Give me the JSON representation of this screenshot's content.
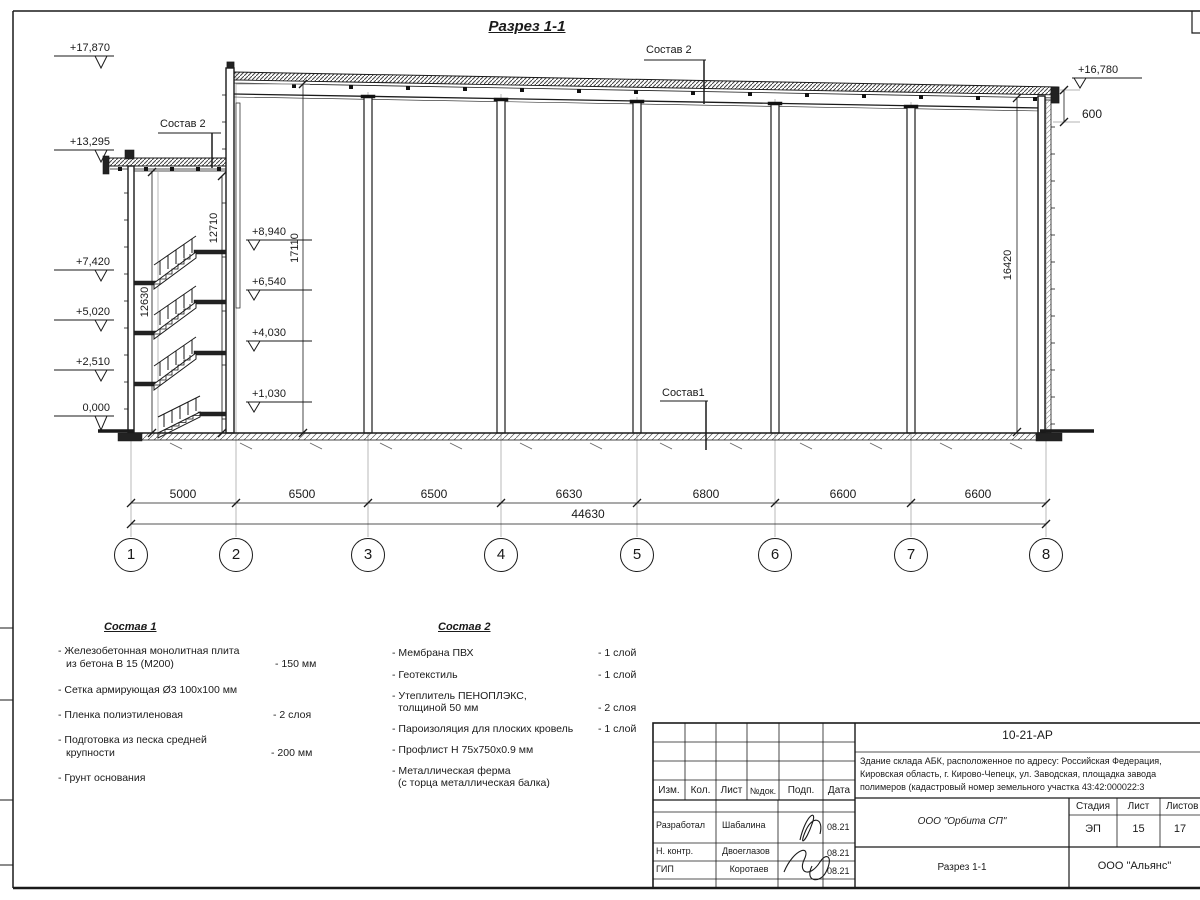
{
  "sheet": {
    "title": "Разрез 1-1"
  },
  "callouts": {
    "sostav2_roof_top": "Состав 2",
    "sostav2_roof_left": "Состав 2",
    "sostav1_floor": "Состав1"
  },
  "elevations": {
    "left": [
      "+17,870",
      "+13,295",
      "+7,420",
      "+5,020",
      "+2,510",
      "0,000"
    ],
    "stair": [
      "+8,940",
      "+6,540",
      "+4,030",
      "+1,030"
    ],
    "right": "+16,780",
    "parapet_offset": "600"
  },
  "vdims": {
    "stair_inner": "12630",
    "stair_outer": "12710",
    "hall_left": "17110",
    "hall_right": "16420"
  },
  "hdims": {
    "spans": [
      "5000",
      "6500",
      "6500",
      "6630",
      "6800",
      "6600",
      "6600"
    ],
    "total": "44630"
  },
  "grid": [
    "1",
    "2",
    "3",
    "4",
    "5",
    "6",
    "7",
    "8"
  ],
  "legend1": {
    "heading": "Состав 1",
    "items": [
      {
        "line1": "- Железобетонная  монолитная плита",
        "line2": "из бетона В 15 (М200)",
        "value": "- 150 мм"
      },
      {
        "line1": "- Сетка армирующая Ø3 100x100 мм"
      },
      {
        "line1": "- Пленка полиэтиленовая",
        "value": "-  2 слоя"
      },
      {
        "line1": "- Подготовка из песка средней",
        "line2": "крупности",
        "value": "- 200 мм"
      },
      {
        "line1": "- Грунт основания"
      }
    ]
  },
  "legend2": {
    "heading": "Состав 2",
    "items": [
      {
        "line1": "- Мембрана ПВХ",
        "value": "- 1 слой"
      },
      {
        "line1": "- Геотекстиль",
        "value": "- 1 слой"
      },
      {
        "line1": "- Утеплитель ПЕНОПЛЭКС,",
        "line2": "толщиной 50 мм",
        "value": "- 2 слоя"
      },
      {
        "line1": "- Пароизоляция для плоских кровель",
        "value": "- 1 слой"
      },
      {
        "line1": "- Профлист Н 75x750x0.9 мм"
      },
      {
        "line1": "- Металлическая ферма",
        "line2": "(с торца металлическая балка)"
      }
    ]
  },
  "titleblock": {
    "doc_number": "10-21-АР",
    "description_lines": [
      "Здание склада АБК, расположенное по адресу: Российская Федерация,",
      "Кировская область, г. Кирово-Чепецк, ул. Заводская, площадка завода",
      "полимеров (кадастровый номер земельного участка 43:42:000022:3"
    ],
    "header_cols": [
      "Изм.",
      "Кол.",
      "Лист",
      "№док.",
      "Подп.",
      "Дата"
    ],
    "rows": [
      {
        "role": "Разработал",
        "name": "Шабалина",
        "date": "08.21"
      },
      {
        "role": "Н. контр.",
        "name": "Двоеглазов",
        "date": "08.21"
      },
      {
        "role": "ГИП",
        "name": "Коротаев",
        "date": "08.21"
      }
    ],
    "company": "ООО \"Орбита СП\"",
    "sheet_title": "Разрез 1-1",
    "contractor": "ООО \"Альянс\"",
    "stage_label": "Стадия",
    "sheet_label": "Лист",
    "sheets_label": "Листов",
    "stage": "ЭП",
    "sheet_no": "15",
    "sheets_total": "17"
  }
}
